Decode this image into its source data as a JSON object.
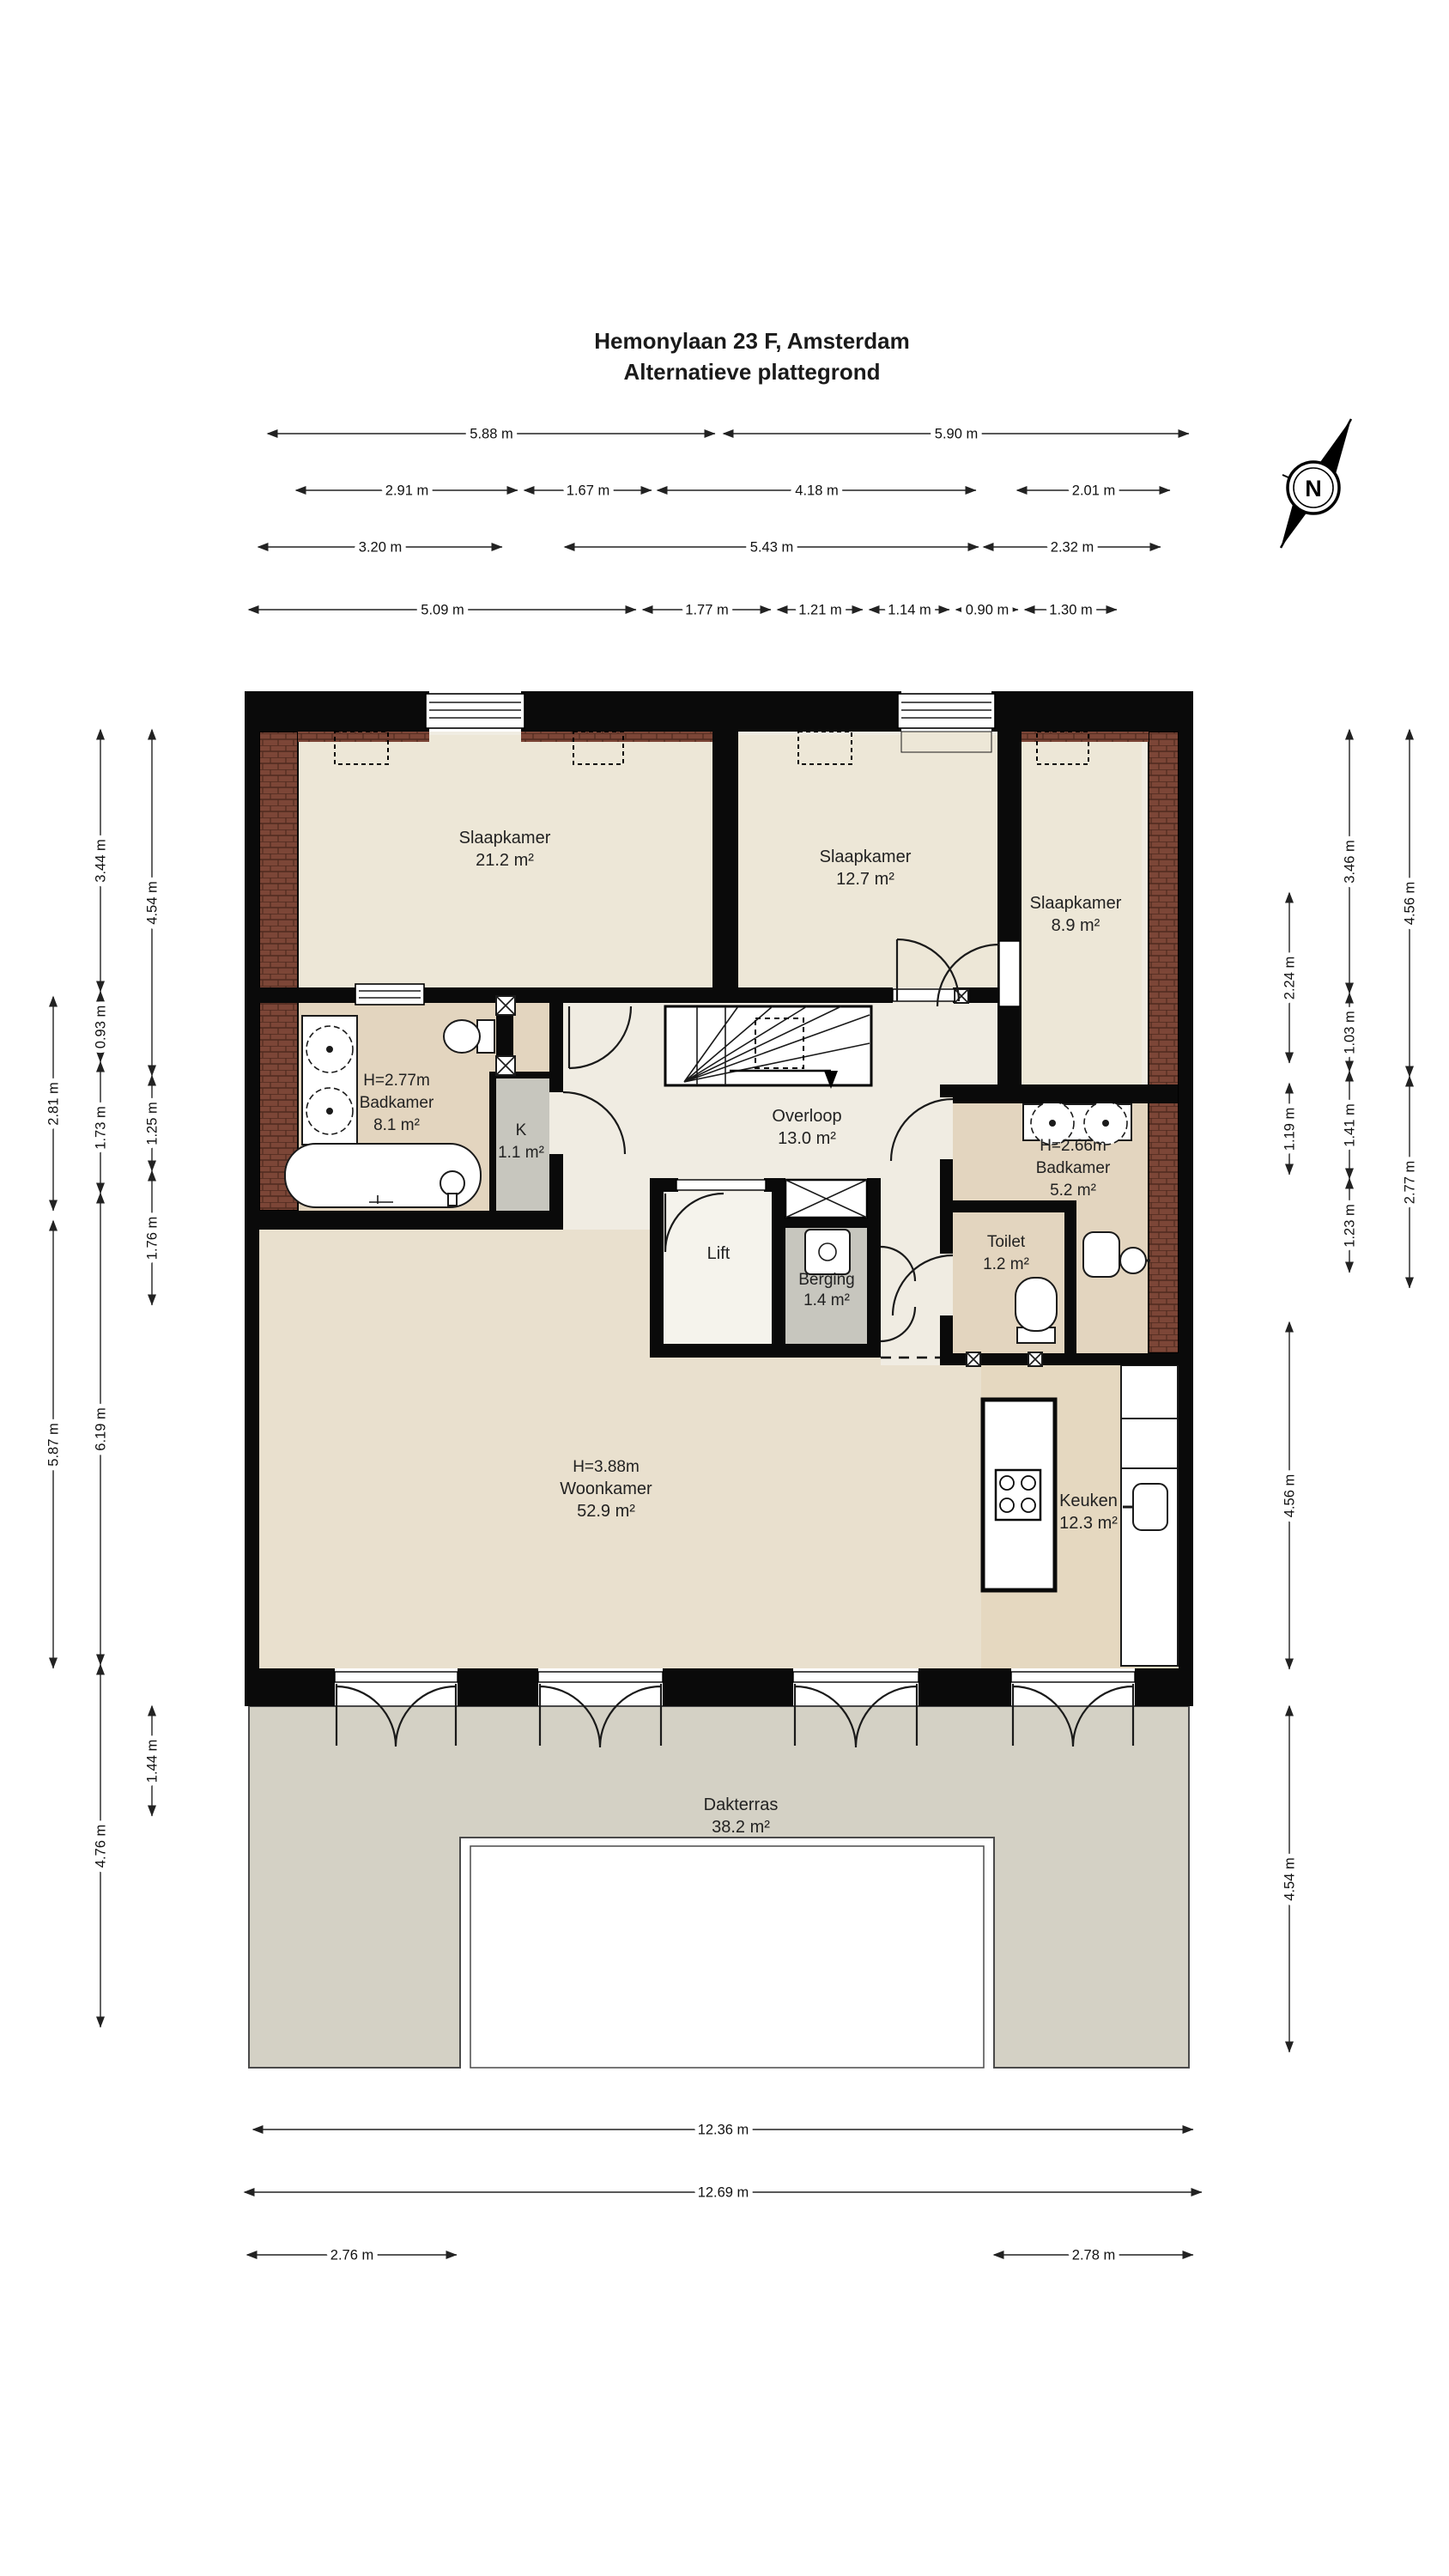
{
  "title": {
    "line1": "Hemonylaan 23 F, Amsterdam",
    "line2": "Alternatieve plattegrond"
  },
  "compass": {
    "north_label": "N"
  },
  "rooms": {
    "slaapkamer_1": {
      "name": "Slaapkamer",
      "area": "21.2 m²"
    },
    "slaapkamer_2": {
      "name": "Slaapkamer",
      "area": "12.7 m²"
    },
    "slaapkamer_3": {
      "name": "Slaapkamer",
      "area": "8.9 m²"
    },
    "badkamer_1": {
      "height": "H=2.77m",
      "name": "Badkamer",
      "area": "8.1 m²"
    },
    "kast": {
      "name": "K",
      "area": "1.1 m²"
    },
    "overloop": {
      "name": "Overloop",
      "area": "13.0 m²"
    },
    "lift": {
      "name": "Lift"
    },
    "berging": {
      "name": "Berging",
      "area": "1.4 m²"
    },
    "toilet": {
      "name": "Toilet",
      "area": "1.2 m²"
    },
    "badkamer_2": {
      "height": "H=2.66m",
      "name": "Badkamer",
      "area": "5.2 m²"
    },
    "woonkamer": {
      "height": "H=3.88m",
      "name": "Woonkamer",
      "area": "52.9 m²"
    },
    "keuken": {
      "name": "Keuken",
      "area": "12.3 m²"
    },
    "dakterras": {
      "name": "Dakterras",
      "area": "38.2 m²"
    }
  },
  "dimensions": {
    "top": [
      [
        "5.88 m",
        "5.90 m"
      ],
      [
        "2.91 m",
        "1.67 m",
        "4.18 m",
        "2.01 m"
      ],
      [
        "3.20 m",
        "5.43 m",
        "2.32 m"
      ],
      [
        "5.09 m",
        "1.77 m",
        "1.21 m",
        "1.14 m",
        "0.90 m",
        "1.30 m"
      ]
    ],
    "bottom": [
      [
        "12.36 m"
      ],
      [
        "12.69 m"
      ],
      [
        "2.76 m",
        "2.78 m"
      ]
    ],
    "left": [
      [
        "2.81 m",
        "5.87 m"
      ],
      [
        "3.44 m",
        "0.93 m",
        "1.73 m",
        "6.19 m",
        "4.76 m"
      ],
      [
        "4.54 m",
        "1.25 m",
        "1.76 m",
        "1.44 m"
      ]
    ],
    "right": [
      [
        "2.24 m",
        "1.19 m",
        "4.56 m",
        "4.54 m"
      ],
      [
        "3.46 m",
        "1.03 m",
        "1.41 m",
        "1.23 m"
      ],
      [
        "4.56 m",
        "2.77 m"
      ]
    ]
  },
  "colors": {
    "wall": "#0a0a0a",
    "floor_base": "#f0ece2",
    "floor_bedroom": "#ede7d7",
    "floor_bath": "#e3d5bf",
    "floor_living": "#e9e0ce",
    "floor_kitchen": "#e5d8c0",
    "floor_storage": "#c7c6be",
    "floor_terrace": "#d4d1c5",
    "brick": "#7c4637"
  }
}
